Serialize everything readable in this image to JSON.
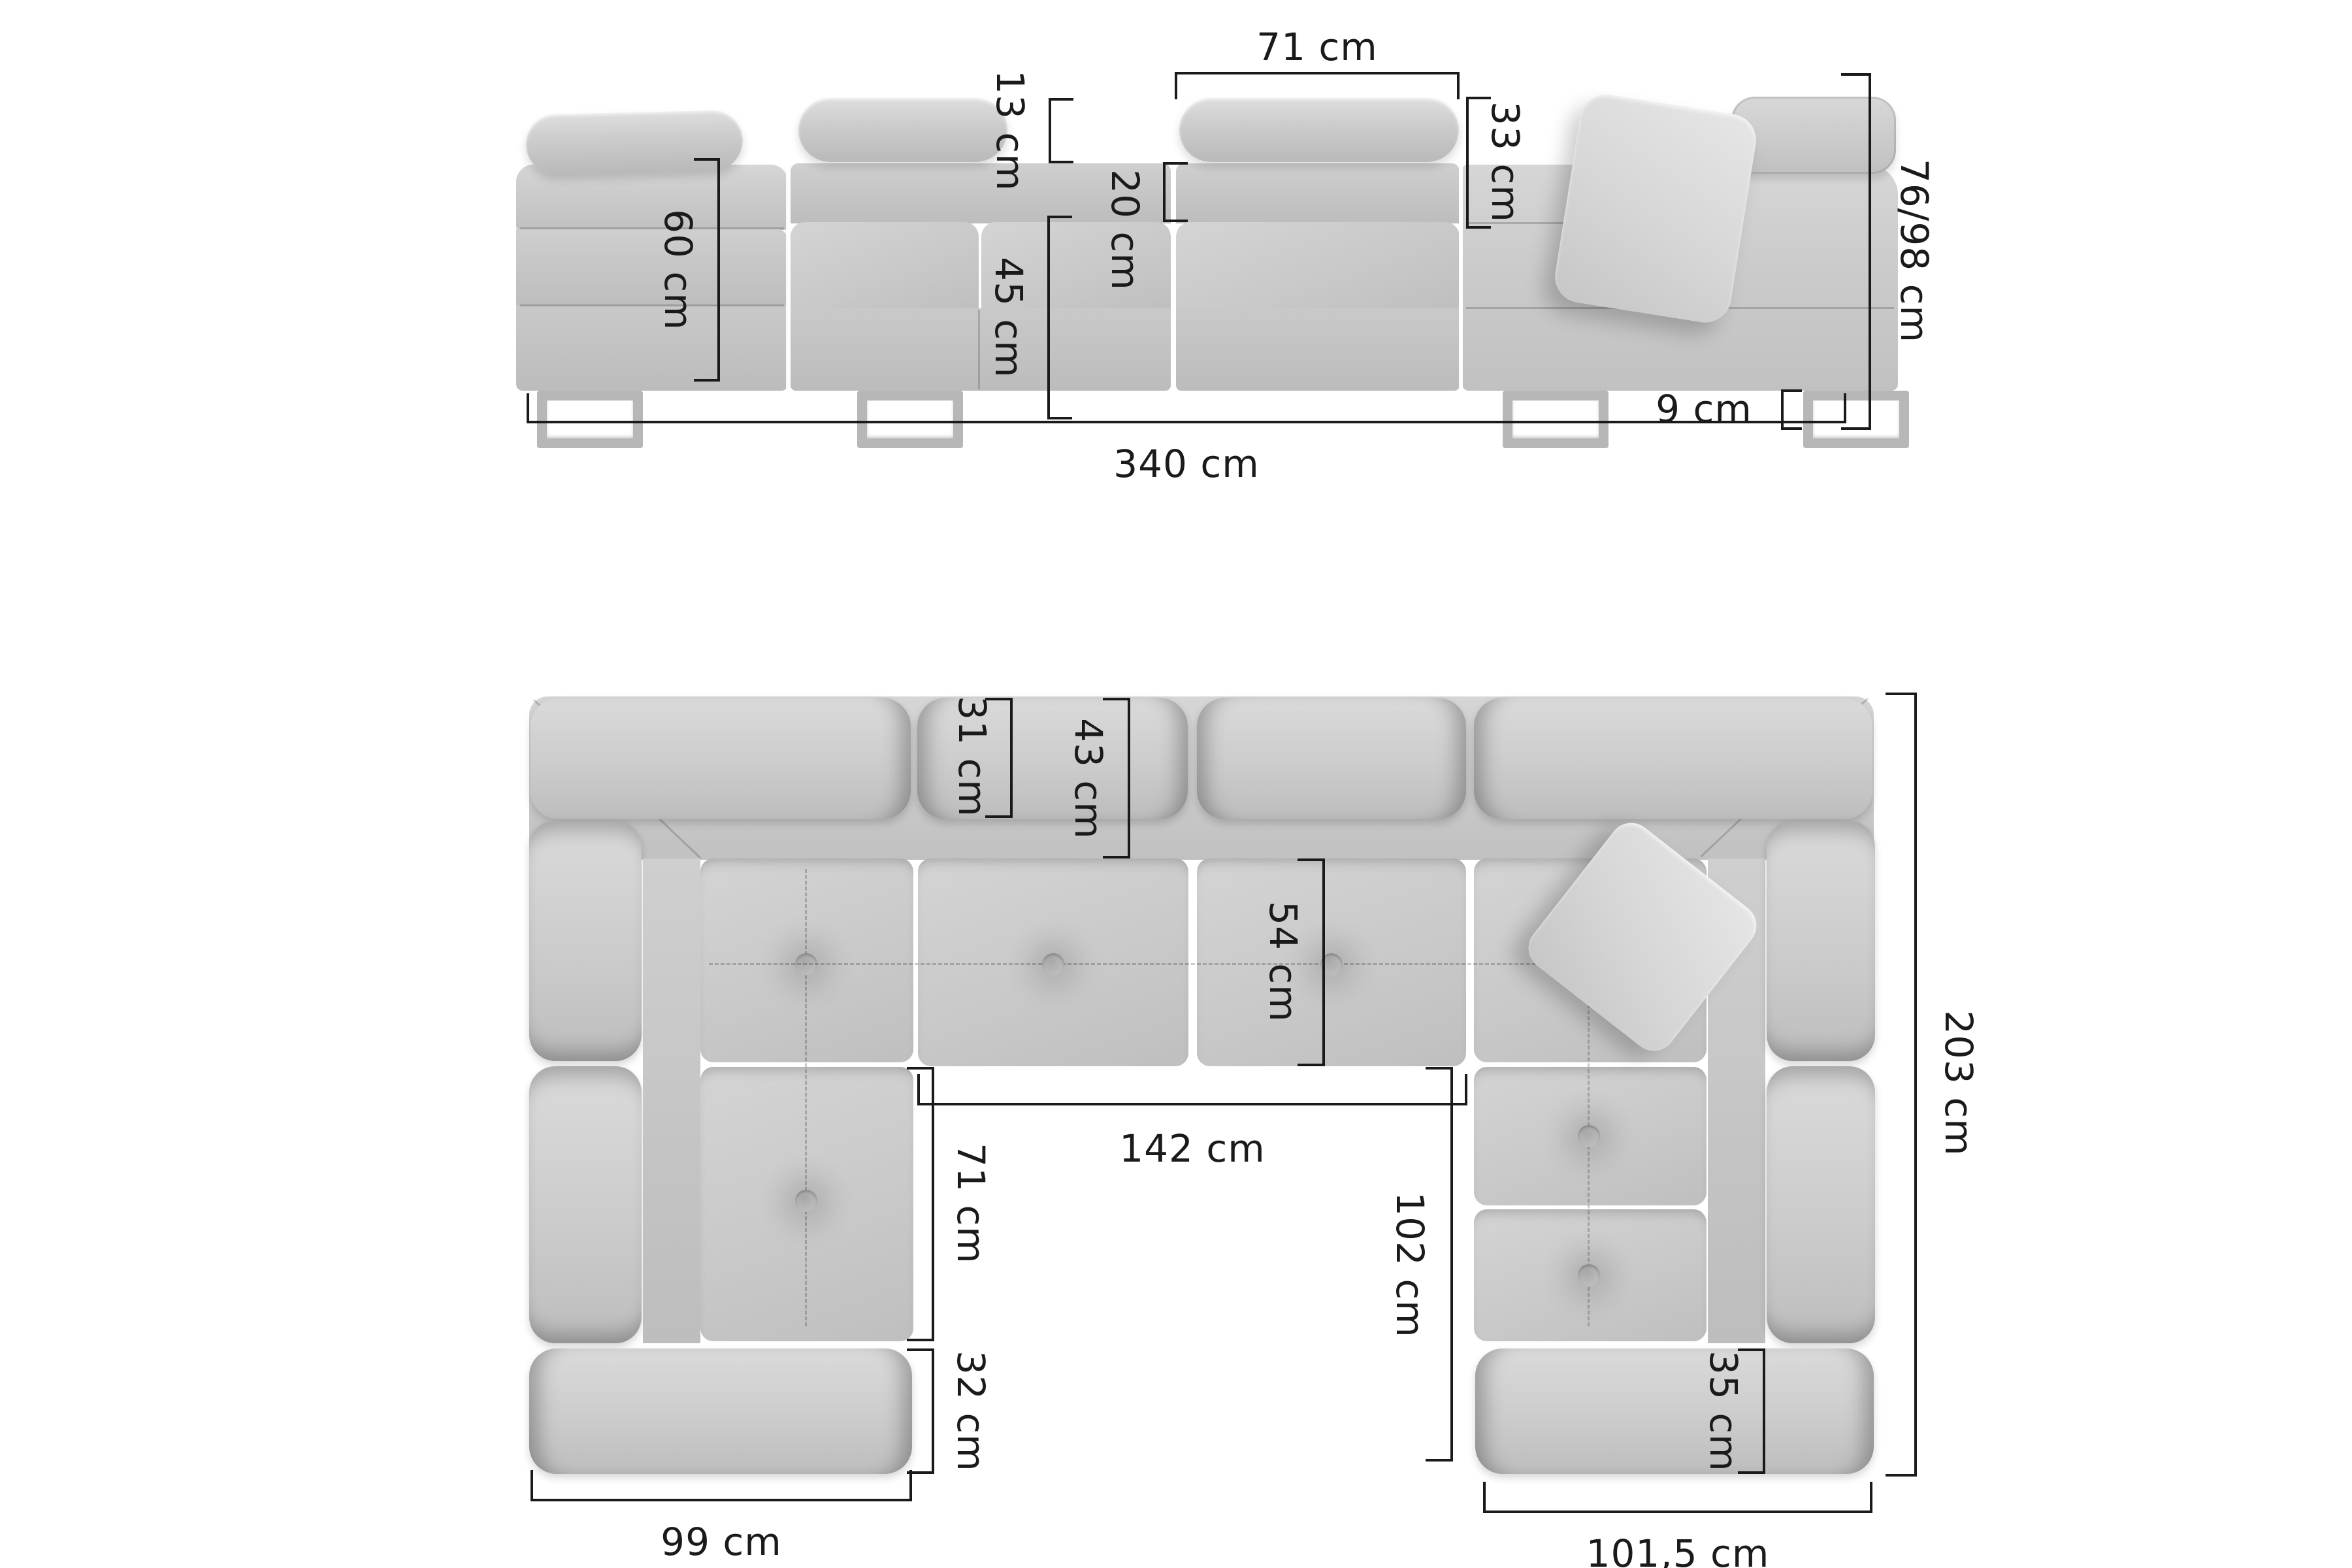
{
  "title": "corner-sofa-dimension-diagram",
  "units": "cm",
  "colors": {
    "bg": "#ffffff",
    "line": "#1a1a1a",
    "body": "#c9c9c9",
    "body_light": "#d8d8d8",
    "body_dark": "#b9b9b9",
    "pillow": "#dcdcdc",
    "leg": "#b7b7b7"
  },
  "front_view": {
    "headrest_width": "71 cm",
    "headrest_height": "13 cm",
    "backrest_top_height": "20 cm",
    "backrest_height": "33 cm",
    "arm_end_height": "60 cm",
    "seat_height": "45 cm",
    "leg_height": "9 cm",
    "total_height": "76/98 cm",
    "total_width": "340 cm"
  },
  "top_view": {
    "back_cushion_depth": "31 cm",
    "backrest_depth": "43 cm",
    "seat_depth": "54 cm",
    "inner_width": "142 cm",
    "left_seat_length": "71 cm",
    "right_seat_length": "102 cm",
    "ottoman_depth": "32 cm",
    "left_wing_width": "99 cm",
    "corner_block_depth": "35 cm",
    "right_wing_width": "101,5 cm",
    "total_depth": "203 cm"
  }
}
